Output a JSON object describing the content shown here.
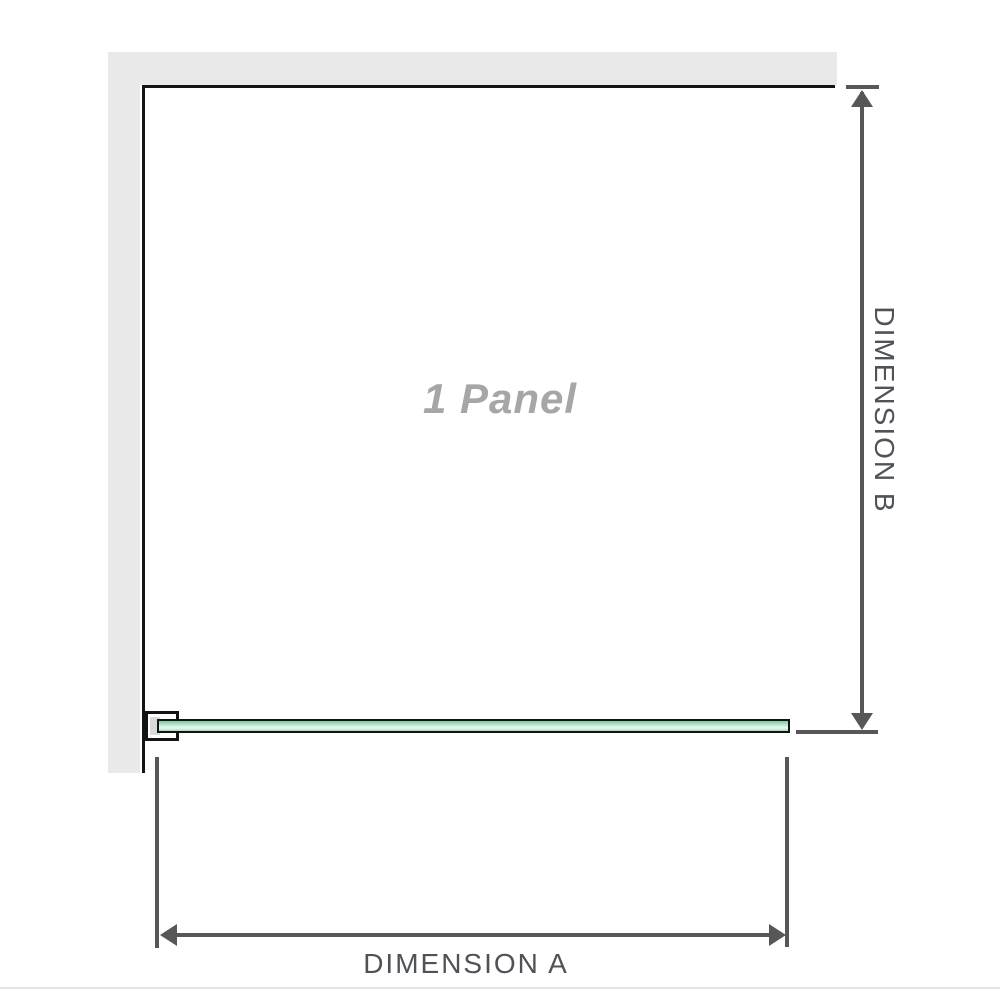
{
  "diagram": {
    "panel_label": "1 Panel",
    "dimensions": {
      "a_label": "DIMENSION A",
      "b_label": "DIMENSION B"
    },
    "colors": {
      "wall": "#e9e9e9",
      "wall_edge": "#141414",
      "dimension_line": "#575757",
      "label_text": "#4f5358",
      "panel_label_text": "#a6a6a6",
      "glass_top": "#7dcba0",
      "glass_light": "#d8f1e3",
      "glass_bottom": "#a2dcc1",
      "gasket": "#d9d9d9",
      "divider": "#e0e6ea"
    }
  }
}
